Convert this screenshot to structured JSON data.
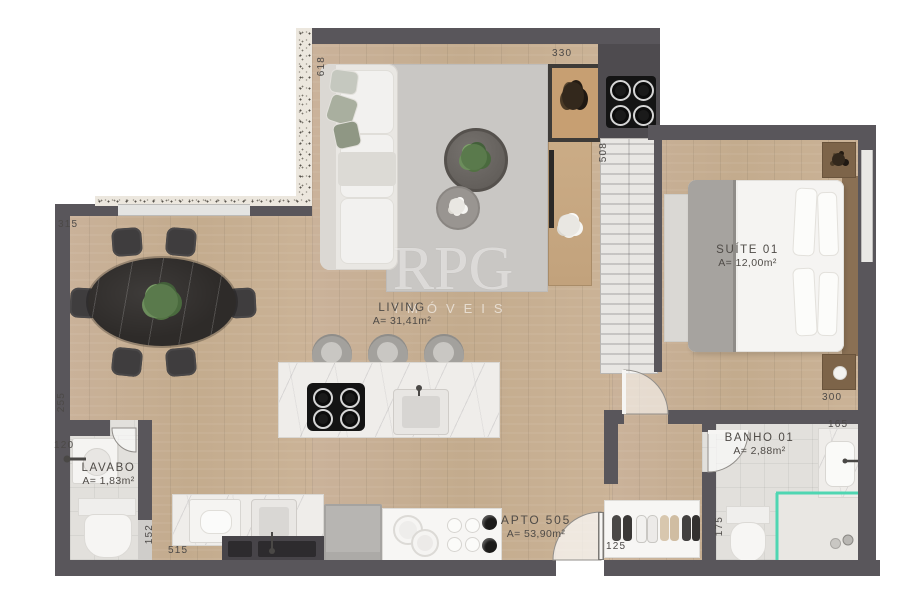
{
  "watermark": {
    "brand": "RPG",
    "subtitle": "IMÓVEIS"
  },
  "unit": {
    "label": "APTO 505",
    "area": "A= 53,90m²"
  },
  "rooms": {
    "living": {
      "name": "LIVING",
      "area": "A= 31,41m²"
    },
    "suite": {
      "name": "SUÍTE 01",
      "area": "A= 12,00m²"
    },
    "lavabo": {
      "name": "LAVABO",
      "area": "A= 1,83m²"
    },
    "banho": {
      "name": "BANHO 01",
      "area": "A= 2,88m²"
    }
  },
  "dimensions": {
    "living_side": "618",
    "top_opening": "330",
    "closet_depth": "508",
    "dining_width": "315",
    "dining_side": "255",
    "lavabo_width": "120",
    "lavabo_depth": "152",
    "kitchen_width": "515",
    "closet_hall": "125",
    "banho_depth": "175",
    "suite_width": "300",
    "banho_counter": "165"
  },
  "colors": {
    "wall": "#59565b",
    "wood": "#c8b095",
    "glass_accent": "#4fd6b2",
    "label_text": "#4c4947"
  }
}
